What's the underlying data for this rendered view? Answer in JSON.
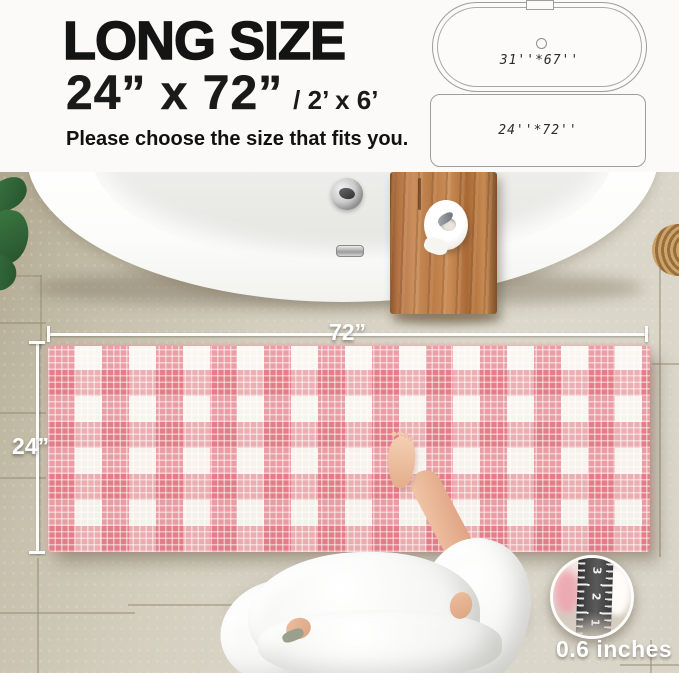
{
  "header": {
    "title": "LONG SIZE",
    "size_primary": "24”  x 72”",
    "size_secondary": "/ 2’ x 6’",
    "subtitle": "Please choose the size that fits you.",
    "tub_diagram_label": "31''*67''",
    "mat_diagram_label": "24''*72''"
  },
  "photo": {
    "width_label": "72”",
    "height_label": "24”",
    "thickness_label": "0.6 inches",
    "ruler_numbers": [
      "3",
      "2",
      "1"
    ]
  },
  "colors": {
    "rug_pink": "#de6c78",
    "wood_brown": "#b47440",
    "floor_beige": "#d6d1c2",
    "text_black": "#141414",
    "dimension_white": "#ffffff"
  }
}
